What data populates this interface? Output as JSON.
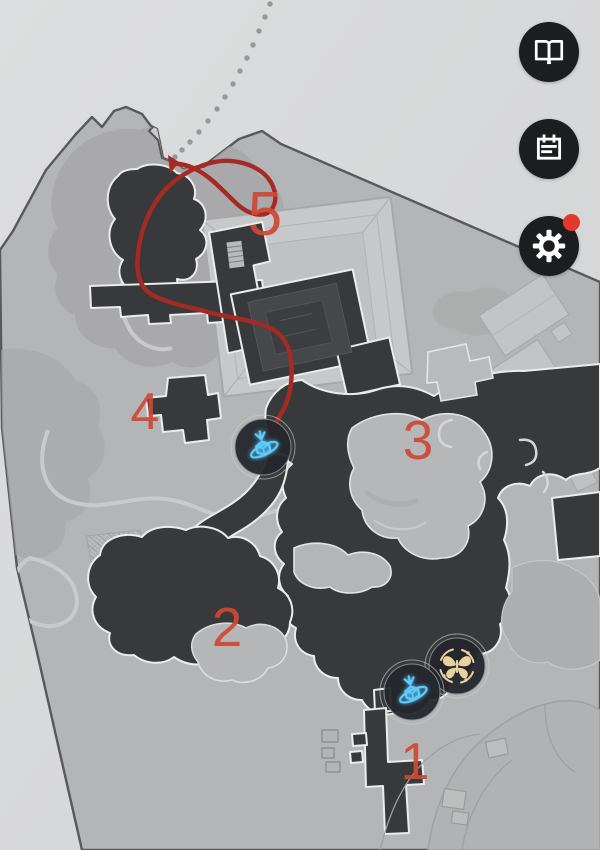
{
  "view": {
    "name": "game-map-view"
  },
  "map": {
    "markers": [
      {
        "id": 1,
        "label": "1"
      },
      {
        "id": 2,
        "label": "2"
      },
      {
        "id": 3,
        "label": "3"
      },
      {
        "id": 4,
        "label": "4"
      },
      {
        "id": 5,
        "label": "5"
      }
    ],
    "pois": [
      {
        "name": "space-anchor-1",
        "icon": "space-anchor-icon"
      },
      {
        "name": "space-anchor-2",
        "icon": "space-anchor-icon"
      },
      {
        "name": "memory-butterfly-1",
        "icon": "butterfly-icon"
      }
    ],
    "route": {
      "style": "solid-red-line-with-arrow",
      "continuation": "dotted-gray-trail"
    }
  },
  "toolbar": {
    "buttons": [
      {
        "name": "guide",
        "icon": "open-book-icon",
        "badge": false
      },
      {
        "name": "notes",
        "icon": "notepad-icon",
        "badge": false
      },
      {
        "name": "settings",
        "icon": "gear-icon",
        "badge": true
      }
    ]
  },
  "colors": {
    "background": "#d8d9da",
    "map_base": "#b4b5b6",
    "map_dark": "#38393b",
    "route_red": "#a62a24",
    "marker_red": "#cf4936",
    "anchor_blue": "#54c8ff",
    "butterfly_gold": "#e7d2a0",
    "button_bg": "#1c1d1f",
    "badge_red": "#e3392c"
  }
}
